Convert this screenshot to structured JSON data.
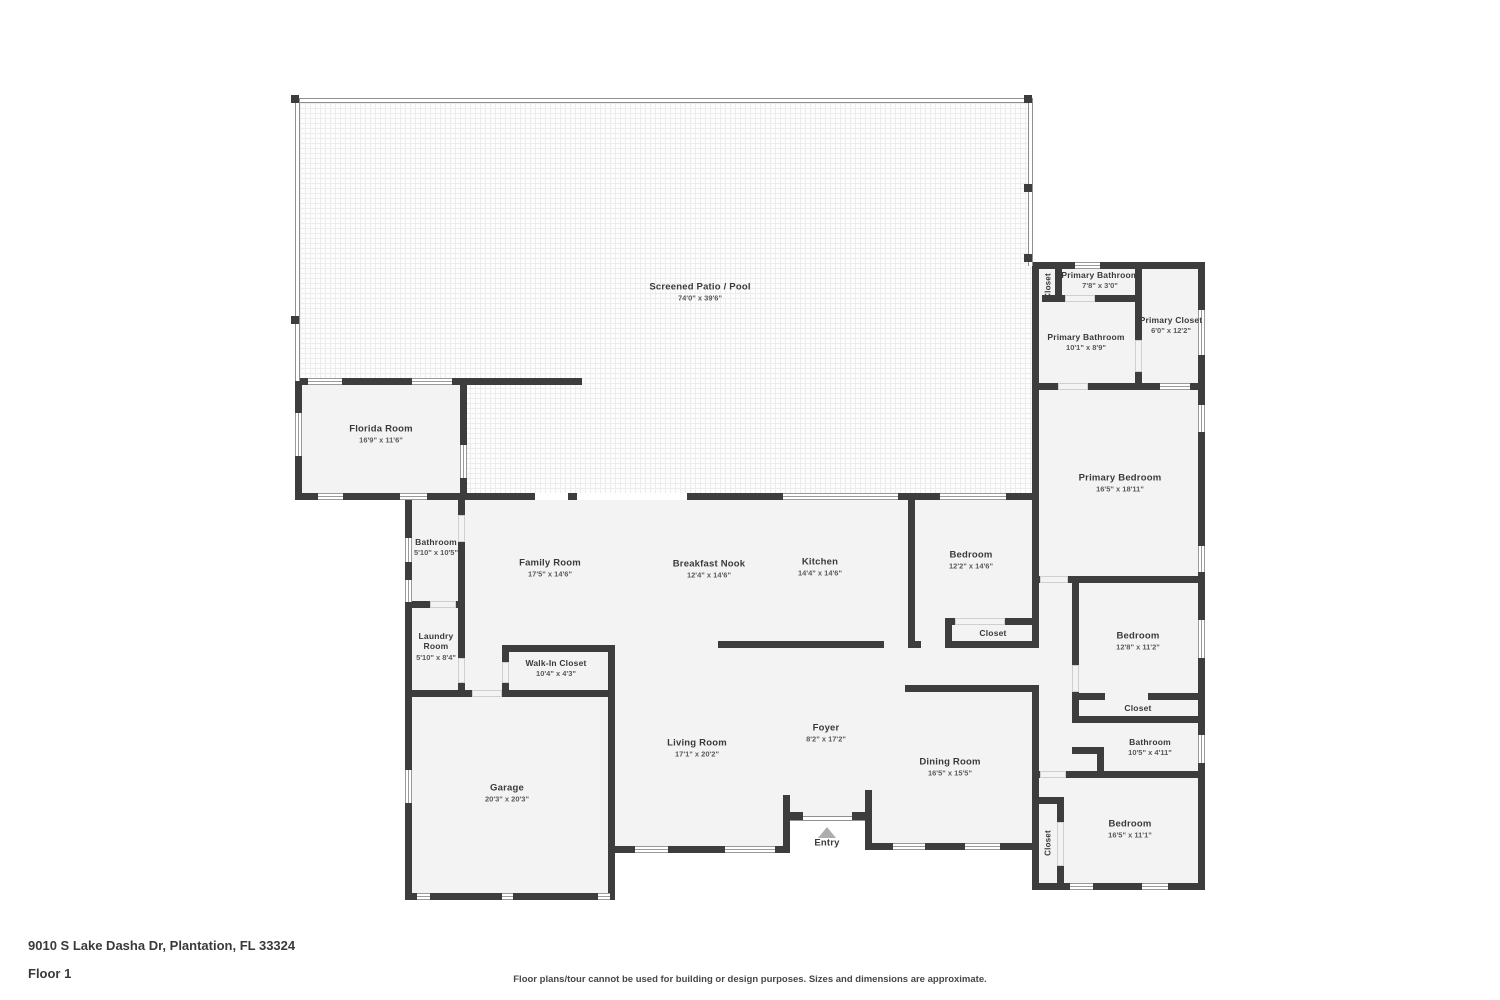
{
  "title": "Floor plan",
  "colors": {
    "wall": "#3d3d3d",
    "floor": "#f3f3f3",
    "patio_grid": "#ececec",
    "label": "#3a3a3a"
  },
  "rooms": {
    "patio": {
      "name": "Screened Patio / Pool",
      "dims": "74'0\" x 39'6\""
    },
    "florida": {
      "name": "Florida Room",
      "dims": "16'9\" x 11'6\""
    },
    "closet_top": {
      "name": "Closet"
    },
    "primary_bathroom_small": {
      "name": "Primary Bathroom",
      "dims": "7'8\" x 3'0\""
    },
    "primary_bathroom": {
      "name": "Primary Bathroom",
      "dims": "10'1\" x 8'9\""
    },
    "primary_closet": {
      "name": "Primary Closet",
      "dims": "6'0\" x 12'2\""
    },
    "primary_bedroom": {
      "name": "Primary Bedroom",
      "dims": "16'5\" x 18'11\""
    },
    "bathroom_main": {
      "name": "Bathroom",
      "dims": "5'10\" x 10'5\""
    },
    "family_room": {
      "name": "Family Room",
      "dims": "17'5\" x 14'6\""
    },
    "breakfast_nook": {
      "name": "Breakfast Nook",
      "dims": "12'4\" x 14'6\""
    },
    "kitchen": {
      "name": "Kitchen",
      "dims": "14'4\" x 14'6\""
    },
    "bedroom_1": {
      "name": "Bedroom",
      "dims": "12'2\" x 14'6\""
    },
    "closet_1": {
      "name": "Closet"
    },
    "laundry_room": {
      "name": "Laundry Room",
      "dims": "5'10\" x 8'4\""
    },
    "walk_in_closet": {
      "name": "Walk-In Closet",
      "dims": "10'4\" x 4'3\""
    },
    "garage": {
      "name": "Garage",
      "dims": "20'3\" x 20'3\""
    },
    "living_room": {
      "name": "Living Room",
      "dims": "17'1\" x 20'2\""
    },
    "foyer": {
      "name": "Foyer",
      "dims": "8'2\" x 17'2\""
    },
    "dining_room": {
      "name": "Dining Room",
      "dims": "16'5\" x 15'5\""
    },
    "bedroom_2": {
      "name": "Bedroom",
      "dims": "12'8\" x 11'2\""
    },
    "closet_2": {
      "name": "Closet"
    },
    "bathroom_2": {
      "name": "Bathroom",
      "dims": "10'5\" x 4'11\""
    },
    "bedroom_3": {
      "name": "Bedroom",
      "dims": "16'5\" x 11'1\""
    },
    "closet_3": {
      "name": "Closet"
    },
    "entry": {
      "name": "Entry"
    }
  },
  "footer": {
    "address": "9010 S Lake Dasha Dr, Plantation, FL 33324",
    "floor": "Floor 1",
    "disclaimer": "Floor plans/tour cannot be used for building or design purposes. Sizes and dimensions are approximate."
  }
}
